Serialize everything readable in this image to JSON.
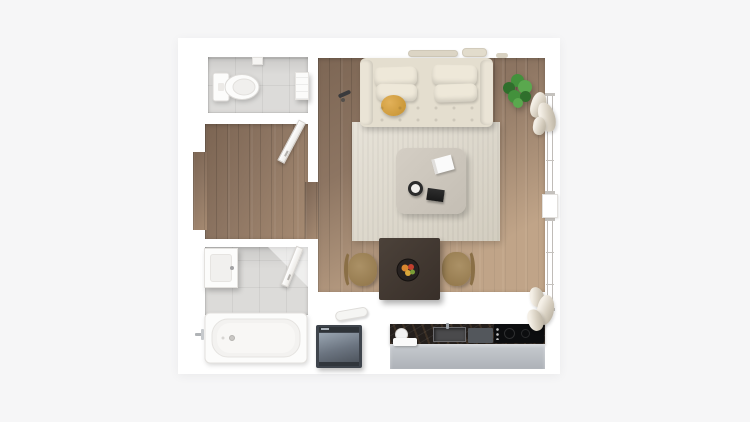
{
  "scene": {
    "type": "apartment-floor-plan-render",
    "view": "top-down-3d",
    "visible_text": "none"
  },
  "rooms": [
    {
      "id": "wc",
      "label": "WC",
      "floor": "light-gray-tile",
      "furniture": [
        "toilet",
        "towel-on-rail",
        "soap-dish"
      ]
    },
    {
      "id": "hallway",
      "label": "Hallway",
      "floor": "wood-plank",
      "furniture": [
        "open-door",
        "entry-recess"
      ]
    },
    {
      "id": "bathroom",
      "label": "Bathroom",
      "floor": "gray-tile",
      "furniture": [
        "bathtub",
        "bath-faucet",
        "sink-vanity",
        "open-door"
      ]
    },
    {
      "id": "living-room",
      "label": "Living room",
      "floor": "wood-plank",
      "furniture": [
        "sofa",
        "back-cushions",
        "round-yellow-pillow",
        "wall-shelf-decor",
        "potted-plant",
        "area-rug",
        "coffee-table",
        "white-book",
        "candle-cup",
        "black-tray",
        "remote-on-floor",
        "dining-table",
        "fruit-bowl",
        "dining-chair-left",
        "dining-chair-right"
      ]
    },
    {
      "id": "kitchen",
      "label": "Kitchen",
      "floor": "white",
      "furniture": [
        "marble-countertop",
        "kitchen-sink",
        "faucet",
        "cutting-board",
        "cooktop",
        "base-cabinets",
        "washing-machine",
        "towel-roll",
        "plate",
        "tray"
      ]
    },
    {
      "id": "window-wall",
      "label": "Window wall",
      "furniture": [
        "window-frame-upper",
        "window-frame-lower",
        "window-sill",
        "curtain-top",
        "curtain-bottom"
      ]
    }
  ],
  "colors": {
    "bg": "#f6f6f7",
    "canvas": "#ffffff",
    "wood": "#8d7562",
    "tile": "#dcdbd9",
    "rug": "#ded8ca",
    "sofa": "#e4decf",
    "cushion": "#eee8d9",
    "pouf-light": "#e2b159",
    "pouf-dark": "#c3902f",
    "coffee-table": "#cdc7bc",
    "espresso": "#463c33",
    "chair-tan": "#a58b60",
    "chair-dark": "#8a6f46",
    "counter": "#241f1c",
    "cabinet": "#bcc1c7",
    "washer": "#3e444c",
    "washer-panel": "#7e8a99",
    "cooktop": "#0c0d0f",
    "plant-dark": "#2f6f2c",
    "plant-mid": "#43913c",
    "plant-light": "#5aa84e",
    "fixture-white": "#fcfcfb",
    "fixture-line": "#dbd9d6"
  }
}
